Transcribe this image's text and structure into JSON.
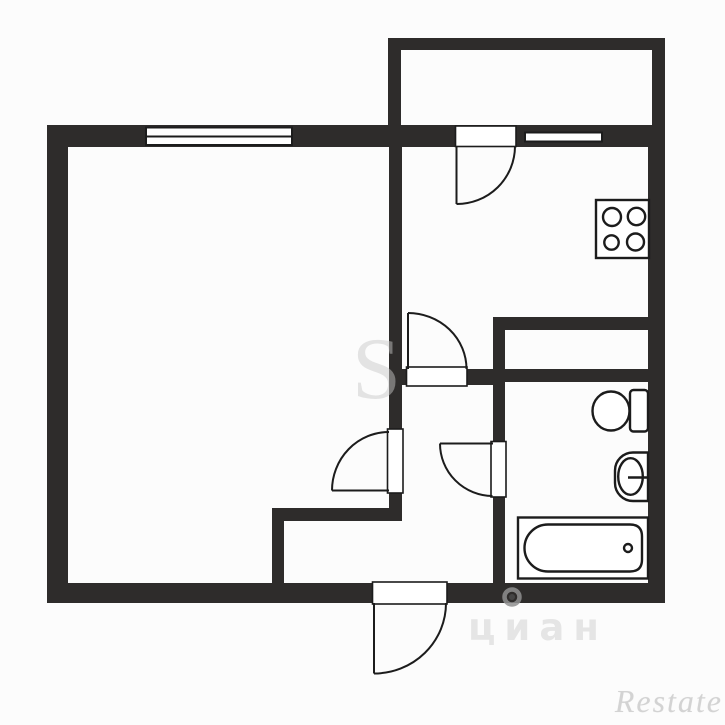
{
  "image": {
    "kind": "one-room apartment floor plan, black walls on white background"
  },
  "watermarks": {
    "center_letter": "S",
    "cian_text": "циан",
    "restate_text": "Restate"
  },
  "colors": {
    "bg": "#fcfcfc",
    "wall": "#2e2c2b",
    "line": "#1c1c1c",
    "fill": "#ffffff"
  },
  "rooms": [
    {
      "name": "living-room"
    },
    {
      "name": "kitchen"
    },
    {
      "name": "balcony"
    },
    {
      "name": "hallway"
    },
    {
      "name": "bathroom"
    },
    {
      "name": "duct-closet"
    }
  ],
  "windows": [
    {
      "name": "living-room-window",
      "wall": "top"
    },
    {
      "name": "kitchen-window",
      "wall": "top"
    }
  ],
  "doors": [
    {
      "name": "balcony-door",
      "swing": "into kitchen"
    },
    {
      "name": "kitchen-door",
      "swing": "into kitchen"
    },
    {
      "name": "living-room-door",
      "swing": "into living room"
    },
    {
      "name": "bathroom-door",
      "swing": "into hallway"
    },
    {
      "name": "entrance-door",
      "swing": "outward"
    }
  ],
  "fixtures": [
    {
      "name": "stove-icon",
      "burners": 4
    },
    {
      "name": "toilet-icon"
    },
    {
      "name": "sink-icon"
    },
    {
      "name": "bathtub-icon"
    }
  ]
}
